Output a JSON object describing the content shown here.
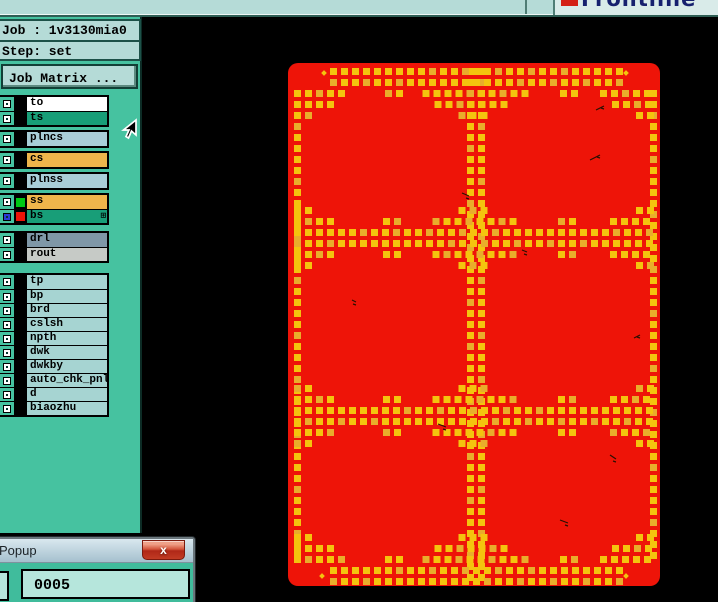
{
  "logo": {
    "text": "Frontline"
  },
  "job_panel": {
    "job": "Job : 1v3130mia0",
    "step": "Step: set",
    "matrix_button": "Job Matrix ..."
  },
  "layers": {
    "matrix_icon_glyph": "⊞",
    "segments": [
      {
        "rows": [
          {
            "label": "to",
            "swatch": "#000000",
            "bg": "#ffffff"
          },
          {
            "label": "ts",
            "swatch": "#000000",
            "bg": "#189e78"
          }
        ]
      },
      {
        "rows": [
          {
            "label": "plncs",
            "swatch": "#000000",
            "bg": "#a9ced8"
          }
        ]
      },
      {
        "rows": [
          {
            "label": "cs",
            "swatch": "#000000",
            "bg": "#efb54b"
          }
        ]
      },
      {
        "rows": [
          {
            "label": "plnss",
            "swatch": "#000000",
            "bg": "#a9ced8"
          }
        ]
      },
      {
        "rows": [
          {
            "label": "ss",
            "swatch": "#00c814",
            "bg": "#efb54b"
          },
          {
            "label": "bs",
            "swatch": "#ee1408",
            "bg": "#189e78",
            "selected": true,
            "matrix_icon": true
          }
        ]
      },
      {
        "rows": [
          {
            "label": "drl",
            "swatch": "#000000",
            "bg": "#7f97a7"
          },
          {
            "label": "rout",
            "swatch": "#000000",
            "bg": "#c6cac6"
          }
        ]
      },
      {
        "rows": [
          {
            "label": "tp",
            "swatch": "#000000",
            "bg": "#a6d4d2"
          },
          {
            "label": "bp",
            "swatch": "#000000",
            "bg": "#a6d4d2"
          },
          {
            "label": "brd",
            "swatch": "#000000",
            "bg": "#a6d4d2"
          },
          {
            "label": "cslsh",
            "swatch": "#000000",
            "bg": "#a6d4d2"
          },
          {
            "label": "npth",
            "swatch": "#000000",
            "bg": "#a6d4d2"
          },
          {
            "label": "dwk",
            "swatch": "#000000",
            "bg": "#a6d4d2"
          },
          {
            "label": "dwkby",
            "swatch": "#000000",
            "bg": "#a6d4d2"
          },
          {
            "label": "auto_chk_pnl",
            "swatch": "#000000",
            "bg": "#a6d4d2"
          },
          {
            "label": "d",
            "swatch": "#000000",
            "bg": "#a6d4d2"
          },
          {
            "label": "biaozhu",
            "swatch": "#000000",
            "bg": "#a6d4d2"
          }
        ]
      }
    ]
  },
  "popup": {
    "title": "Popup",
    "close_glyph": "x",
    "value": "0005"
  },
  "colors": {
    "panel_red": "#ee1408",
    "vent_yellow": "#f4c40e",
    "vent_yellow_alt": "#e9ad2b",
    "canvas_bg": "#000000",
    "sidebar_teal": "#46c2a0",
    "bar_light": "#b5dbd7"
  }
}
